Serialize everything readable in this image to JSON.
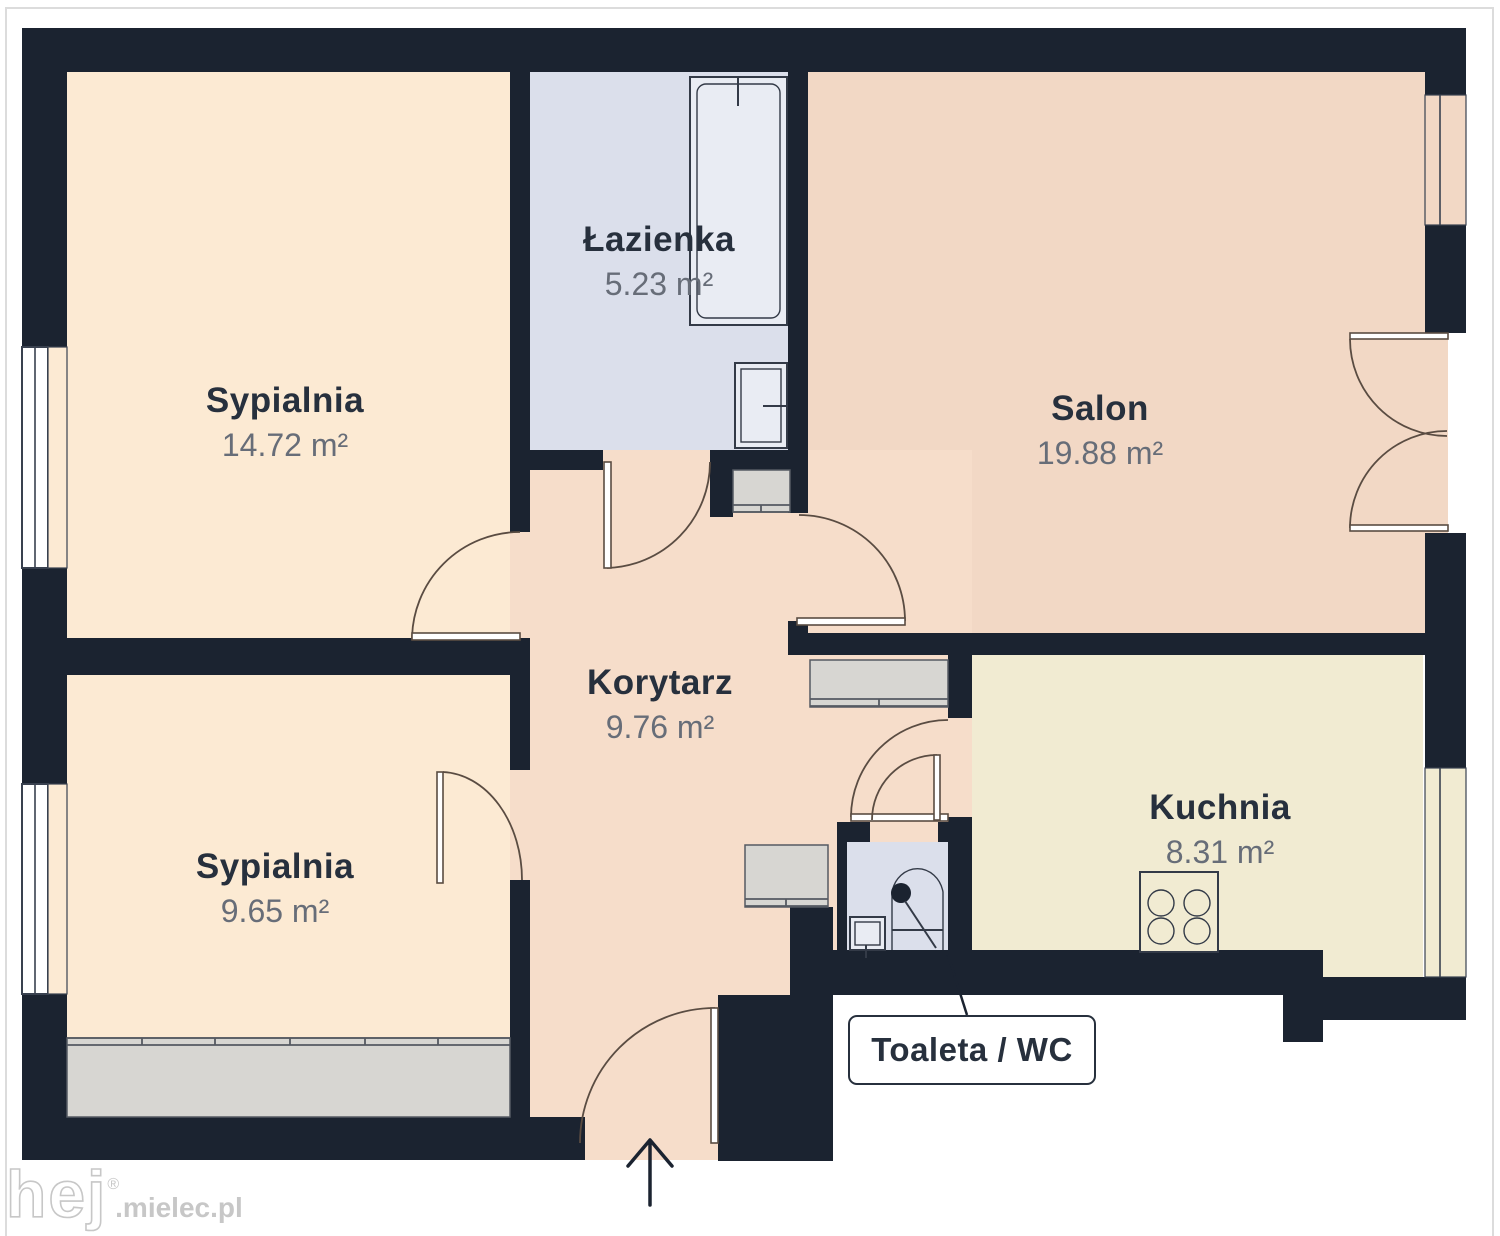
{
  "title": "Rzut mieszkania (floor plan)",
  "colors": {
    "page": "#ffffff",
    "frame": "#dcdcdc",
    "wall": "#1b2330",
    "bedroom": "#fcead3",
    "bathroom": "#dbdfeb",
    "salon": "#f2d8c5",
    "corridor": "#f6ddca",
    "kitchen": "#f1ebd2",
    "cabinet": "#d7d6d2",
    "cabline": "#555a62",
    "fixture": "#e9ecf3",
    "fixline": "#333a47",
    "doorline": "#5a4c42",
    "winline": "#39414f",
    "text-dark": "#27303d",
    "text-gray": "#676d78",
    "watermark": "#c7c7c7"
  },
  "rooms": [
    {
      "id": "sypialnia-1",
      "name": "Sypialnia",
      "area": "14.72 m²"
    },
    {
      "id": "lazienka",
      "name": "Łazienka",
      "area": "5.23 m²"
    },
    {
      "id": "salon",
      "name": "Salon",
      "area": "19.88 m²"
    },
    {
      "id": "korytarz",
      "name": "Korytarz",
      "area": "9.76 m²"
    },
    {
      "id": "sypialnia-2",
      "name": "Sypialnia",
      "area": "9.65 m²"
    },
    {
      "id": "kuchnia",
      "name": "Kuchnia",
      "area": "8.31 m²"
    }
  ],
  "callout": {
    "label": "Toaleta / WC"
  },
  "watermark": {
    "logo": "hej",
    "reg": "®",
    "suffix": ".mielec.pl"
  }
}
